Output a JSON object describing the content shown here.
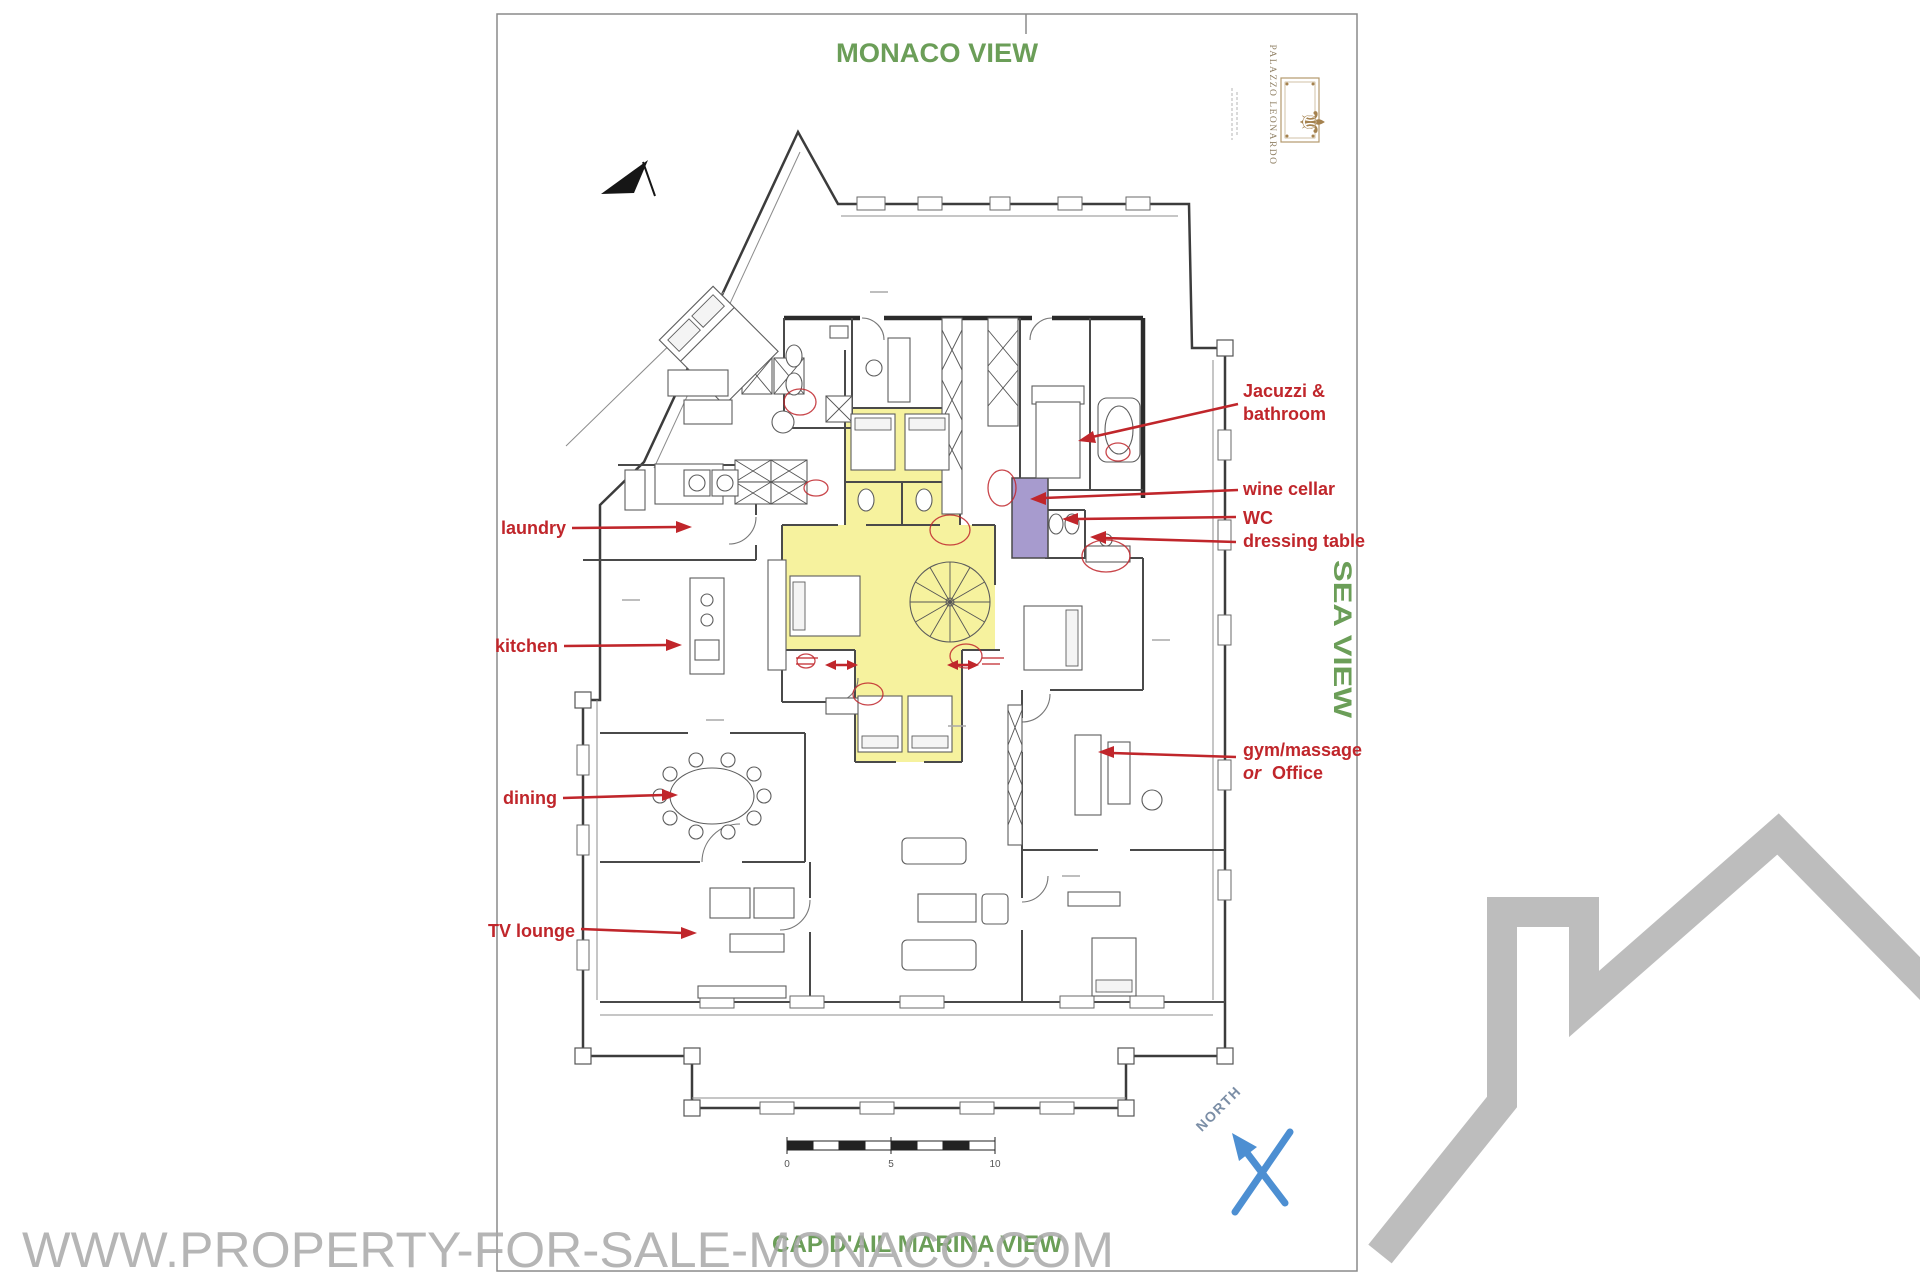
{
  "views": {
    "top": "MONACO VIEW",
    "right": "SEA VIEW",
    "bottom": "CAP D'AIL MARINA VIEW"
  },
  "watermark": {
    "text": "WWW.PROPERTY-FOR-SALE-MONACO.COM"
  },
  "logo": {
    "title": "PALAZZO LEONARDO",
    "emblem_icon": "fleur-de-lis-icon",
    "emblem_glyph": "⚜"
  },
  "compass": {
    "label": "NORTH"
  },
  "scale_bar": {
    "start": "0",
    "middle": "5",
    "end": "10"
  },
  "annotations": {
    "laundry": "laundry",
    "kitchen": "kitchen",
    "dining": "dining",
    "tv_lounge": "TV lounge",
    "jacuzzi_line1": "Jacuzzi &",
    "jacuzzi_line2": "bathroom",
    "wine_cellar": "wine cellar",
    "wc": "WC",
    "dressing_table": "dressing table",
    "gym_line1": "gym/massage",
    "gym_or": "or",
    "gym_office": "Office"
  },
  "colors": {
    "view_green": "#6b9e58",
    "annotation_red": "#c0262b",
    "highlight_yellow": "#f3ee7d",
    "wine_cellar_purple": "#a79bce",
    "north_blue": "#4d8fd2",
    "watermark_gray": "#a9a9a9",
    "logo_gold": "#a5824f",
    "house_gray": "#bdbdbd"
  }
}
